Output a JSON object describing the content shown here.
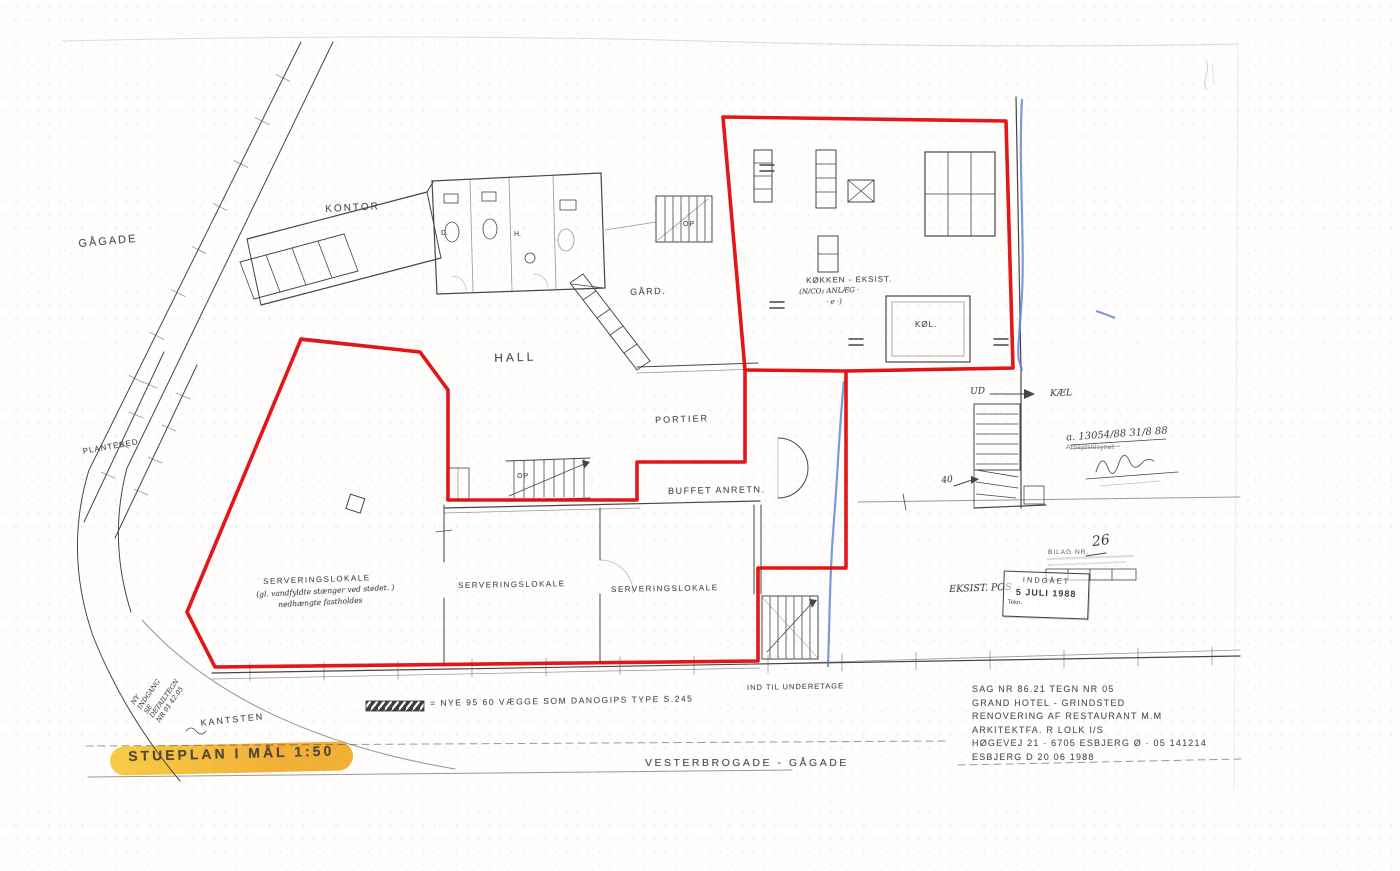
{
  "colors": {
    "red_outline": "#e10505",
    "blue_pen": "#5b7fd4",
    "highlight_marker": "#f0a51c",
    "ink": "#464646"
  },
  "plan": {
    "labels": [
      {
        "id": "street-gagade",
        "text": "GÅGADE",
        "x": 78,
        "y": 238,
        "rot": -5,
        "fs": 11,
        "ls": 2
      },
      {
        "id": "room-kontor",
        "text": "KONTOR",
        "x": 325,
        "y": 204,
        "rot": -3,
        "fs": 10,
        "ls": 2
      },
      {
        "id": "plantebed",
        "text": "PLANTEBED",
        "x": 82,
        "y": 447,
        "rot": -10,
        "fs": 8,
        "ls": 1
      },
      {
        "id": "room-gaard",
        "text": "GÅRD.",
        "x": 630,
        "y": 287,
        "rot": -2,
        "fs": 9,
        "ls": 1.5
      },
      {
        "id": "room-hall",
        "text": "HALL",
        "x": 494,
        "y": 351,
        "rot": -2,
        "fs": 12,
        "ls": 3
      },
      {
        "id": "room-portier",
        "text": "PORTIER",
        "x": 655,
        "y": 415,
        "rot": -2,
        "fs": 9,
        "ls": 2
      },
      {
        "id": "room-buffet-anretn",
        "text": "BUFFET ANRETN.",
        "x": 668,
        "y": 486,
        "rot": -1,
        "fs": 9,
        "ls": 1.5
      },
      {
        "id": "room-serveringslokale-1",
        "text": "SERVERINGSLOKALE",
        "x": 263,
        "y": 577,
        "rot": -2,
        "fs": 8,
        "ls": 1.5
      },
      {
        "id": "serv-note-1",
        "text": "(gl. vandfyldte stænger ved stedet. )",
        "x": 256,
        "y": 590,
        "rot": -3,
        "fs": 7.5,
        "cls": "hand"
      },
      {
        "id": "serv-note-2",
        "text": "nedhængte fastholdes",
        "x": 278,
        "y": 600,
        "rot": -3,
        "fs": 7.5,
        "cls": "hand"
      },
      {
        "id": "room-serveringslokale-2",
        "text": "SERVERINGSLOKALE",
        "x": 458,
        "y": 581,
        "rot": -1,
        "fs": 8,
        "ls": 1.5
      },
      {
        "id": "room-serveringslokale-3",
        "text": "SERVERINGSLOKALE",
        "x": 611,
        "y": 585,
        "rot": -1,
        "fs": 8,
        "ls": 1.5
      },
      {
        "id": "room-koekken",
        "text": "KØKKEN - EKSIST.",
        "x": 806,
        "y": 276,
        "rot": -1,
        "fs": 8,
        "ls": 1
      },
      {
        "id": "koekken-note-1",
        "text": "(N/CO₂ ANLÆG ·",
        "x": 799,
        "y": 288,
        "rot": -2,
        "fs": 7,
        "cls": "hand"
      },
      {
        "id": "koekken-note-2",
        "text": "· e ·)",
        "x": 826,
        "y": 298,
        "rot": -2,
        "fs": 7,
        "cls": "hand"
      },
      {
        "id": "room-koel",
        "text": "KØL.",
        "x": 915,
        "y": 320,
        "rot": 0,
        "fs": 8,
        "ls": 1
      },
      {
        "id": "exit-ud",
        "text": "UD",
        "x": 970,
        "y": 387,
        "rot": -3,
        "fs": 9,
        "cls": "hand"
      },
      {
        "id": "kael",
        "text": "KÆL",
        "x": 1050,
        "y": 389,
        "rot": -2,
        "fs": 9,
        "cls": "hand"
      },
      {
        "id": "note-40",
        "text": "40",
        "x": 941,
        "y": 476,
        "rot": -6,
        "fs": 9,
        "cls": "hand"
      },
      {
        "id": "stair-op-gaard",
        "text": "OP",
        "x": 683,
        "y": 221,
        "rot": 0,
        "fs": 7,
        "ls": 1
      },
      {
        "id": "stair-op-hall",
        "text": "OP",
        "x": 517,
        "y": 473,
        "rot": 0,
        "fs": 7,
        "ls": 1
      },
      {
        "id": "wc-d",
        "text": "D.",
        "x": 441,
        "y": 230,
        "rot": 0,
        "fs": 7
      },
      {
        "id": "wc-h",
        "text": "H.",
        "x": 514,
        "y": 231,
        "rot": 0,
        "fs": 7
      },
      {
        "id": "ny-indgang-note",
        "text": "NY\nINDGANG\nSE DETAILTEGN\nNR 01 42.05",
        "x": 130,
        "y": 702,
        "rot": -55,
        "fs": 6.5,
        "cls": "hand pre"
      },
      {
        "id": "kantsten",
        "text": "KANTSTEN",
        "x": 200,
        "y": 718,
        "rot": -6,
        "fs": 9,
        "ls": 2
      },
      {
        "id": "ind-til-underetage",
        "text": "IND TIL UNDERETAGE",
        "x": 747,
        "y": 683,
        "rot": -1,
        "fs": 7.5,
        "ls": 1
      },
      {
        "id": "legend-text",
        "text": "= NYE 95 60 VÆGGE SOM DANOGIPS TYPE S.245",
        "x": 430,
        "y": 698,
        "rot": -1,
        "fs": 8.5,
        "ls": 1.5
      },
      {
        "id": "plan-title",
        "text": "STUEPLAN I MÅL 1:50",
        "x": 128,
        "y": 748,
        "rot": -1.5,
        "fs": 14,
        "cls": "title"
      },
      {
        "id": "street-vesterbrogade",
        "text": "VESTERBROGADE - GÅGADE",
        "x": 645,
        "y": 757,
        "rot": 0,
        "fs": 10.5,
        "ls": 2.5
      },
      {
        "id": "eksist-pos",
        "text": "EKSIST. POS",
        "x": 949,
        "y": 584,
        "rot": -2,
        "fs": 9.5,
        "cls": "hand"
      }
    ]
  },
  "title_block": {
    "lines": [
      "SAG NR 86.21    TEGN NR 05",
      "GRAND HOTEL - GRINDSTED",
      "RENOVERING AF RESTAURANT M.M",
      "ARKITEKTFA. R LOLK I/S",
      "HØGEVEJ 21 · 6705 ESBJERG Ø · 05 141214",
      "ESBJERG D 20 06 1988"
    ]
  },
  "stamps": {
    "approval": {
      "handwritten": "a. 13054/88    31/8 88",
      "agency": "Arbejdstilsynet"
    },
    "bilag": {
      "label": "BILAG NR.",
      "number": "26"
    },
    "received": {
      "header": "INDGÅET",
      "date": "5 JULI 1988",
      "footer": "Tekn."
    }
  }
}
